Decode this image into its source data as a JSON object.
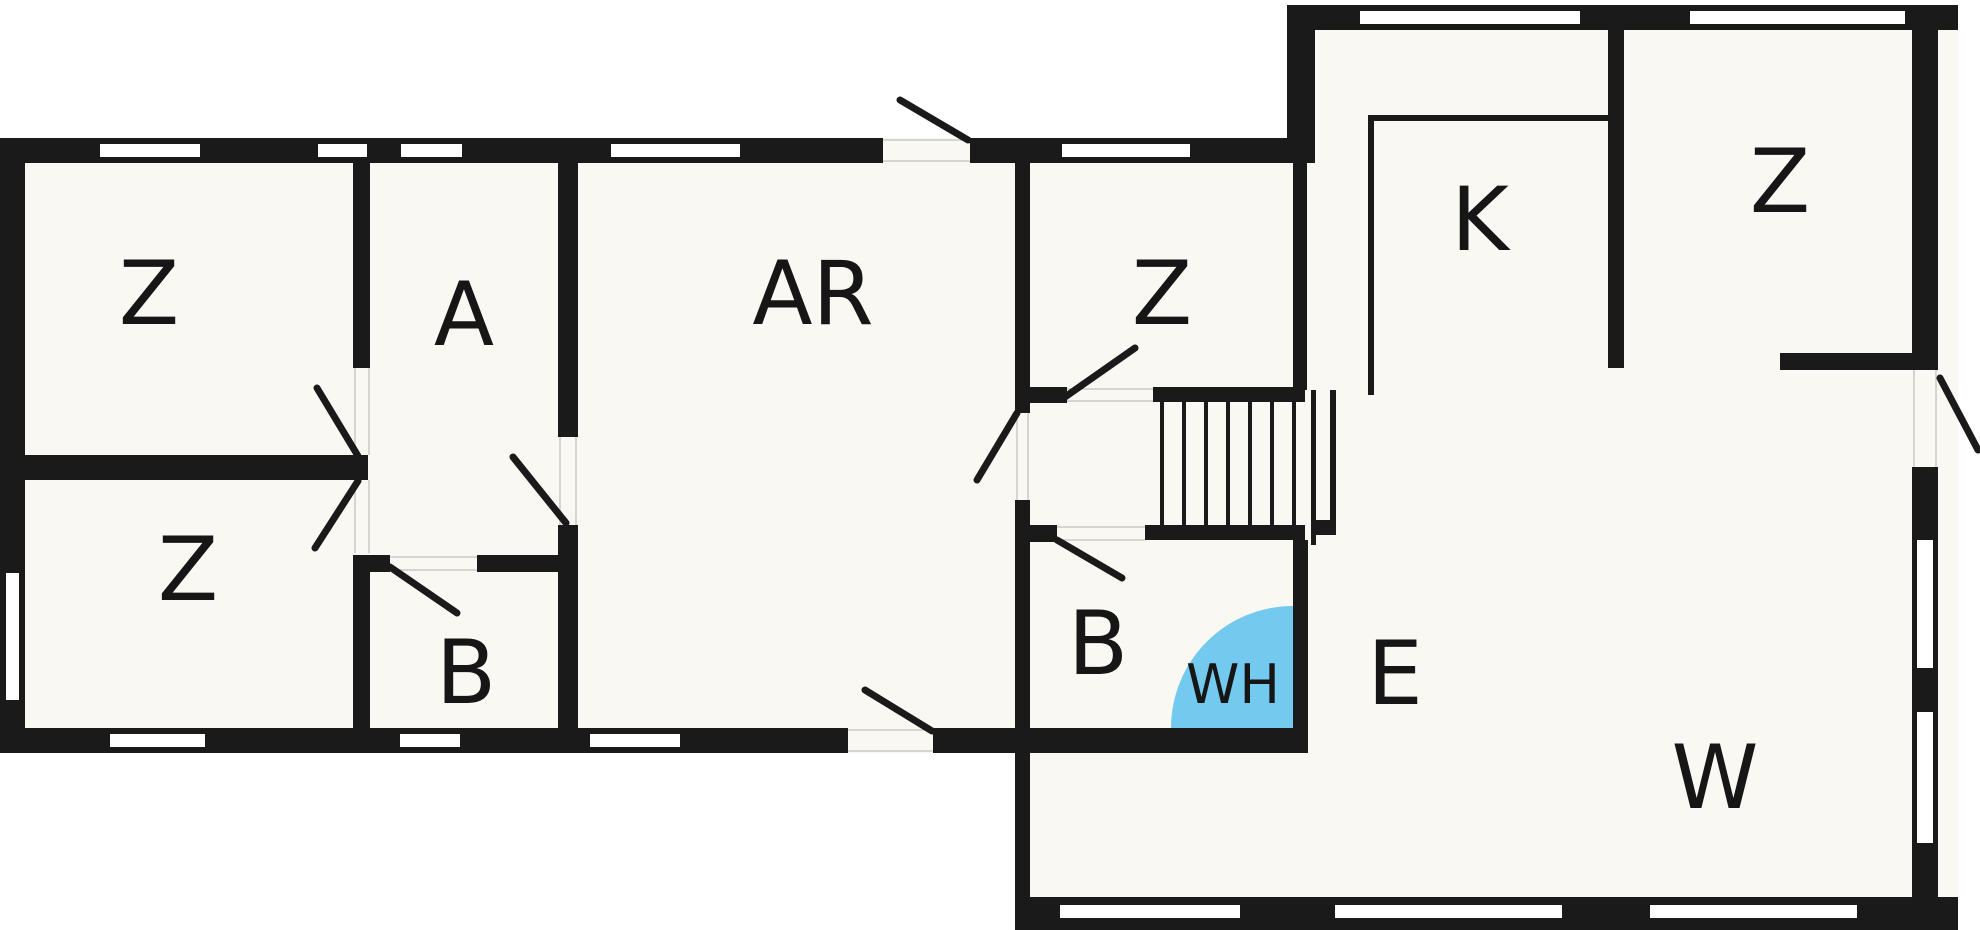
{
  "plan": {
    "type": "floor-plan",
    "colors": {
      "wall": "#1a1a1a",
      "floor": "#f9f8f2",
      "outside": "#ffffff",
      "water_heater_fill": "#74c9ef",
      "threshold_line": "#c9c9c9",
      "label_color": "#161616"
    },
    "stairs": {
      "steps": 7
    },
    "water_heater": {
      "label": "WH"
    },
    "rooms": [
      {
        "id": "z-top-left",
        "label": "Z"
      },
      {
        "id": "z-bottom-left",
        "label": "Z"
      },
      {
        "id": "a-room",
        "label": "A"
      },
      {
        "id": "ar-room",
        "label": "AR"
      },
      {
        "id": "b-room-left",
        "label": "B"
      },
      {
        "id": "z-middle",
        "label": "Z"
      },
      {
        "id": "b-room-right",
        "label": "B"
      },
      {
        "id": "k-room",
        "label": "K"
      },
      {
        "id": "z-top-right",
        "label": "Z"
      },
      {
        "id": "e-room",
        "label": "E"
      },
      {
        "id": "w-room",
        "label": "W"
      }
    ]
  }
}
